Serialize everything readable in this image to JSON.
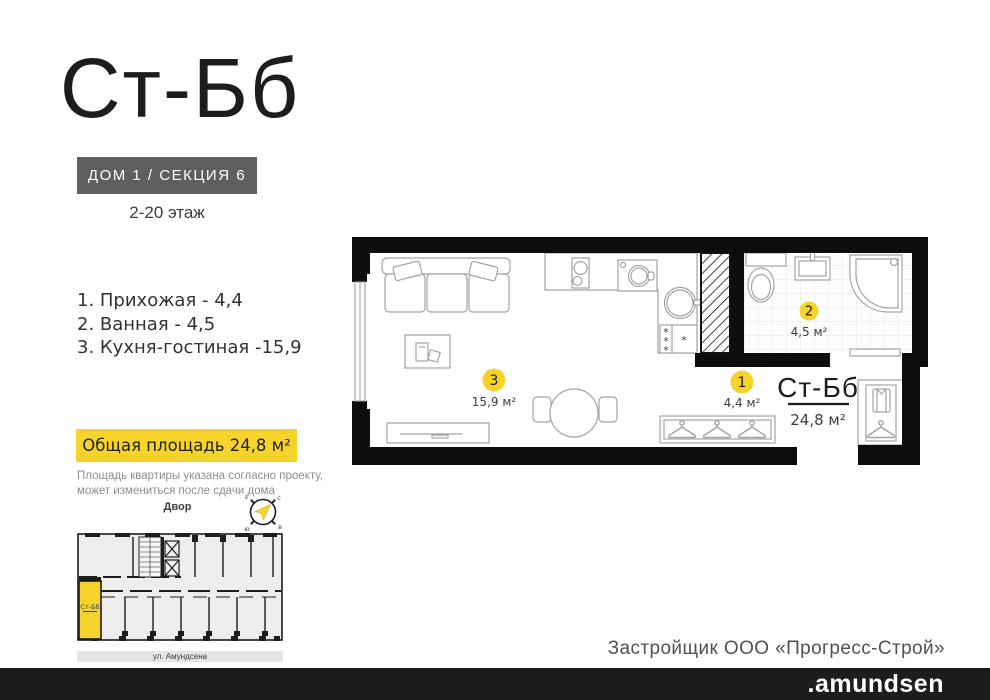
{
  "header": {
    "title": "Ст-Бб",
    "badge": "ДОМ 1 / СЕКЦИЯ 6",
    "floors": "2-20 этаж"
  },
  "rooms": [
    "1. Прихожая - 4,4",
    "2. Ванная - 4,5",
    "3. Кухня-гостиная -15,9"
  ],
  "area_badge": "Общая площадь 24,8 м²",
  "disclaimer": [
    "Площадь квартиры указана согласно проекту,",
    "может измениться после сдачи дома"
  ],
  "yard_label": "Двор",
  "compass": {
    "n": "с",
    "e": "в",
    "s": "ю",
    "w": "з"
  },
  "plan": {
    "n1": "1",
    "a1": "4,4 м²",
    "n2": "2",
    "a2": "4,5 м²",
    "n3": "3",
    "a3": "15,9 м²",
    "unit": "Ст-Бб",
    "total": "24,8 м²"
  },
  "mini": {
    "unit": "Ст-Бб",
    "street": "ул. Амундсена"
  },
  "footer": {
    "developer": "Застройщик ООО «Прогресс-Строй»",
    "brand": ".amundsen"
  },
  "colors": {
    "accent": "#F5D32B",
    "dark": "#1D1D1B",
    "badge_gray": "#605F5D"
  }
}
